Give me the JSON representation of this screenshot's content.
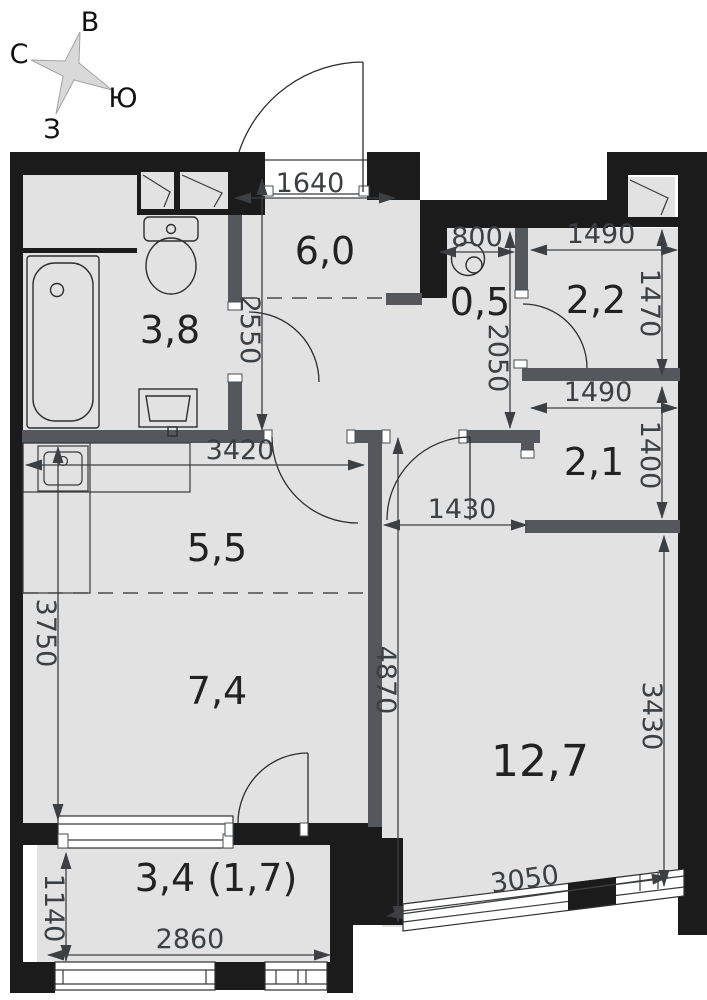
{
  "title": "apartment-floor-plan",
  "compass": {
    "north": "С",
    "east": "В",
    "south": "Ю",
    "west": "З"
  },
  "rooms": {
    "bathroom": "3,8",
    "hall": "6,0",
    "laundry": "0,5",
    "storage_top": "2,2",
    "storage_bottom": "2,1",
    "corridor": "5,5",
    "kitchen": "7,4",
    "living": "12,7",
    "balcony": "3,4 (1,7)"
  },
  "dimensions_mm": {
    "entry_opening": "1640",
    "laundry_width": "800",
    "storage_top_width": "1490",
    "storage_top_depth": "1470",
    "storage_bottom_width": "1490",
    "storage_bottom_depth": "1400",
    "hall_depth": "2550",
    "corridor_depth": "2050",
    "corridor_width": "3420",
    "living_door_opening": "1430",
    "kitchen_wall": "3750",
    "living_wall_left": "4870",
    "living_wall_right": "3430",
    "living_window": "3050",
    "balcony_depth": "1140",
    "balcony_width": "2860"
  },
  "colors": {
    "wall": "#1b1b1b",
    "partition": "#54585c",
    "floor": "#e2e2e2",
    "dimension": "#3c4043"
  }
}
